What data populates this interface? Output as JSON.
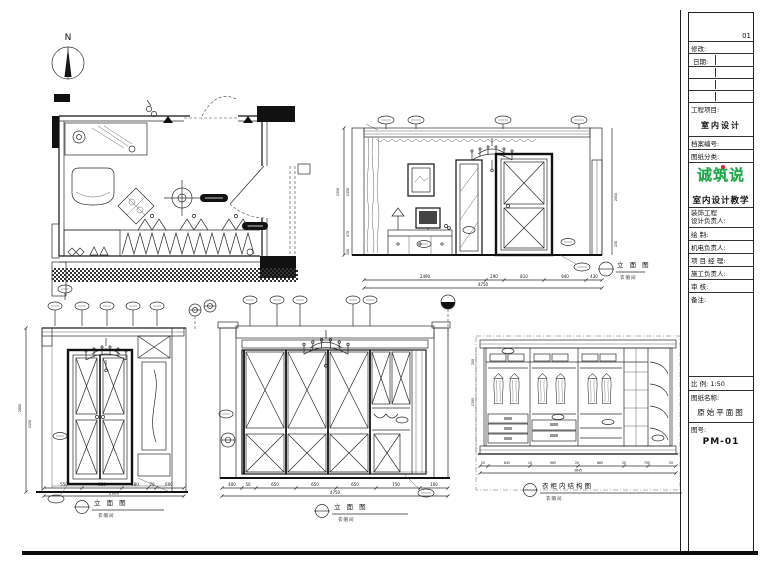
{
  "north": {
    "label": "N"
  },
  "titleblock": {
    "page_no": "01",
    "revision": "修改:",
    "date": "日期:",
    "project_label": "工程项目:",
    "project_value": "室内设计",
    "file_no": "档案编号:",
    "category": "图纸分类:",
    "logo": "诚筑说",
    "logo_sub": "室内设计教学",
    "staff1a": "装饰工程",
    "staff1b": "设计负责人:",
    "staff2": "绘  制:",
    "staff3": "机电负责人:",
    "staff4": "项 目 经 理:",
    "staff5": "施工负责人:",
    "staff6": "审  核:",
    "remarks": "备注:",
    "scale_label": "比  例:",
    "scale_value": "1:50",
    "sheet_name_label": "图纸名称:",
    "sheet_name": "原始平面图",
    "sheet_no_label": "图号:",
    "sheet_no": "PM-01"
  },
  "drawings": {
    "elev_a": {
      "title": "立 面 图",
      "subtitle": "衣帽间",
      "dims_bottom": [
        "2490",
        "290",
        "810",
        "940",
        "430"
      ],
      "dims_bottom_total": "4750",
      "dims_left": [
        "1450",
        "470",
        "100"
      ],
      "dims_left_total": "2350",
      "dims_right": [
        "2050",
        "230"
      ]
    },
    "elev_b": {
      "title": "立 面 图",
      "subtitle": "衣帽间",
      "dims_bottom": [
        "550",
        "810",
        "480",
        "20",
        "600"
      ],
      "dims_bottom_total": "2900",
      "dims_left": [
        "2150"
      ],
      "dims_left_total": "2800"
    },
    "elev_c": {
      "title": "立 面 图",
      "subtitle": "衣帽间",
      "dims_bottom": [
        "400",
        "50",
        "650",
        "650",
        "650",
        "750",
        "100"
      ],
      "dims_bottom_total": "4750"
    },
    "wardrobe": {
      "title": "衣柜内结构图",
      "subtitle": "衣帽间",
      "dims_bottom": [
        "20",
        "845",
        "20",
        "965",
        "20",
        "865",
        "20",
        "750",
        "20"
      ],
      "dims_bottom_total": "3645",
      "dims_left": [
        "200",
        "1500"
      ]
    }
  }
}
